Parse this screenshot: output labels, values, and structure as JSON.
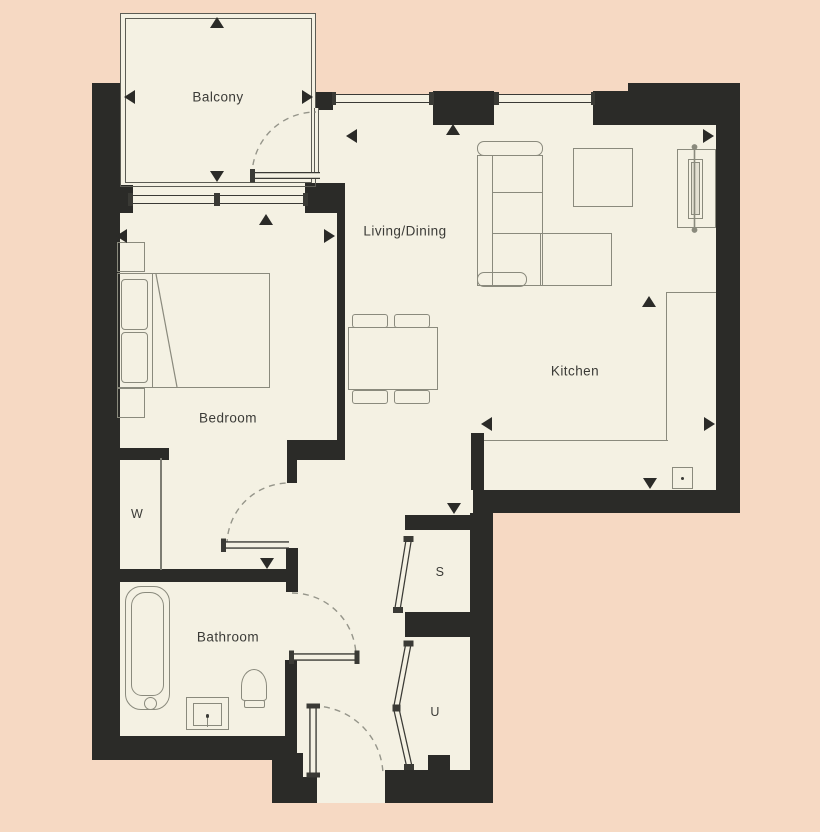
{
  "title": "Apartment floor plan",
  "rooms": {
    "balcony": {
      "label": "Balcony"
    },
    "living_dining": {
      "label": "Living/Dining"
    },
    "kitchen": {
      "label": "Kitchen"
    },
    "bedroom": {
      "label": "Bedroom"
    },
    "bathroom": {
      "label": "Bathroom"
    },
    "wardrobe": {
      "label": "W"
    },
    "store": {
      "label": "S"
    },
    "utility": {
      "label": "U"
    }
  },
  "colors": {
    "background": "#f6d9c3",
    "floor": "#f4f1e3",
    "wall": "#2b2b28",
    "furniture_line": "#8a8a7d",
    "label_text": "#3b3b37"
  },
  "icons": [
    "dimension-arrow-up-icon",
    "dimension-arrow-down-icon",
    "dimension-arrow-left-icon",
    "dimension-arrow-right-icon",
    "door-swing-arc-icon",
    "window-icon",
    "sink-icon"
  ]
}
